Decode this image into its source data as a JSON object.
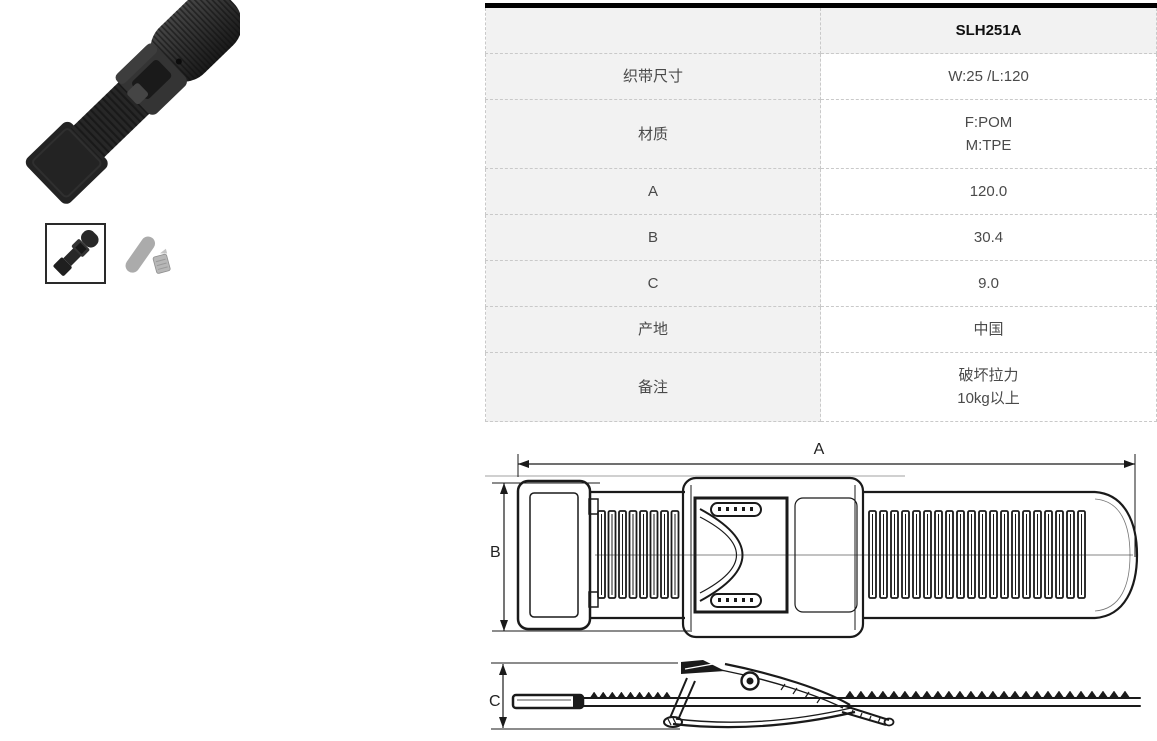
{
  "theme": {
    "table_top_border": "#000000",
    "table_label_bg": "#f2f2f2",
    "table_border": "#c9c9c9",
    "text_color": "#4a4a4a",
    "header_text": "#111111",
    "drawing_line": "#1a1a1a"
  },
  "product": {
    "photo_alt": "black plastic strap buckle, diagonal product photo",
    "thumbnails": [
      {
        "alt": "black buckle assembled",
        "selected": true
      },
      {
        "alt": "gray buckle parts (strap and clip)",
        "selected": false
      }
    ]
  },
  "spec_table": {
    "header": {
      "label": "",
      "model": "SLH251A"
    },
    "rows": [
      {
        "label": "织带尺寸",
        "values": [
          "W:25 /L:120"
        ]
      },
      {
        "label": "材质",
        "values": [
          "F:POM",
          "M:TPE"
        ]
      },
      {
        "label": "A",
        "values": [
          "120.0"
        ]
      },
      {
        "label": "B",
        "values": [
          "30.4"
        ]
      },
      {
        "label": "C",
        "values": [
          "9.0"
        ]
      },
      {
        "label": "产地",
        "values": [
          "中国"
        ]
      },
      {
        "label": "备注",
        "values": [
          "破坏拉力",
          "10kg以上"
        ]
      }
    ]
  },
  "drawing": {
    "dim_labels": {
      "a": "A",
      "b": "B",
      "c": "C"
    }
  }
}
